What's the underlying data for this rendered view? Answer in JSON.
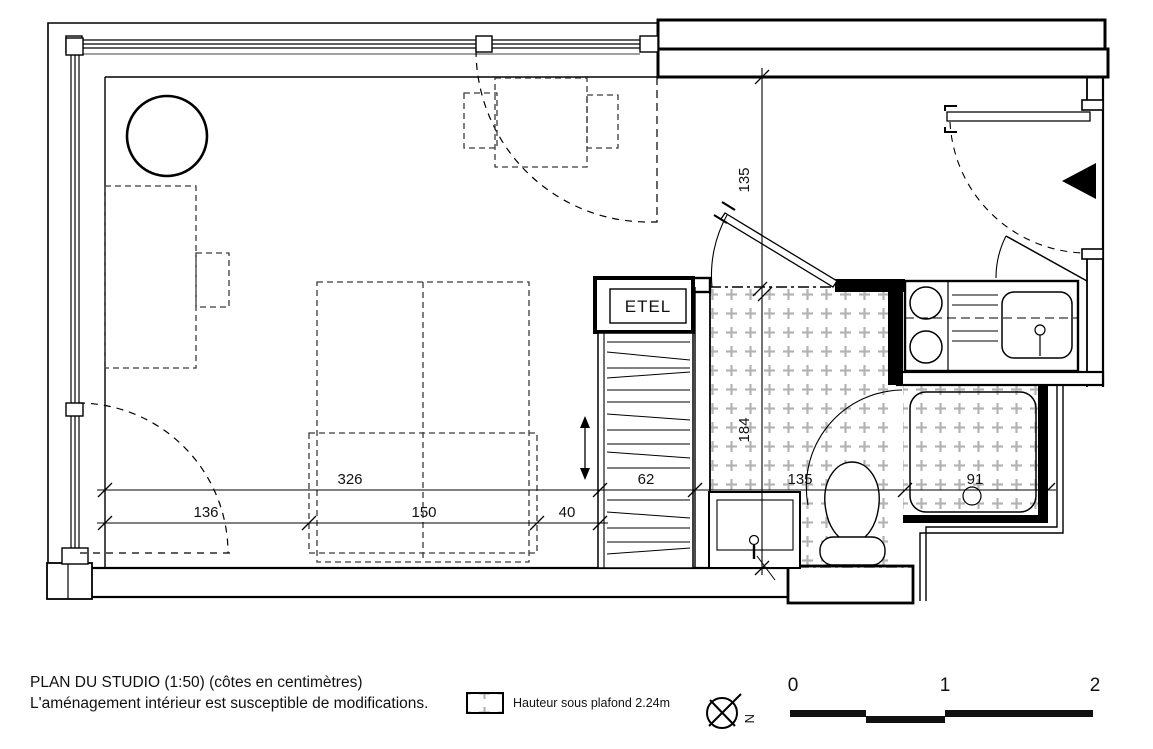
{
  "title": {
    "line1": "PLAN DU STUDIO (1:50) (côtes en centimètres)",
    "line2": "L'aménagement intérieur est susceptible de modifications."
  },
  "legend": {
    "label": "Hauteur sous plafond 2.24m"
  },
  "compass": {
    "north": "N"
  },
  "scale_bar": {
    "labels": [
      "0",
      "1",
      "2"
    ]
  },
  "labels": {
    "closet": "ETEL"
  },
  "dimensions": {
    "upper": [
      "326",
      "62",
      "135",
      "91"
    ],
    "lower": [
      "136",
      "150",
      "40"
    ],
    "vertical": [
      "135",
      "184"
    ]
  },
  "colors": {
    "line": "#000000",
    "hatch": "#b3b3b3",
    "background": "#ffffff"
  }
}
